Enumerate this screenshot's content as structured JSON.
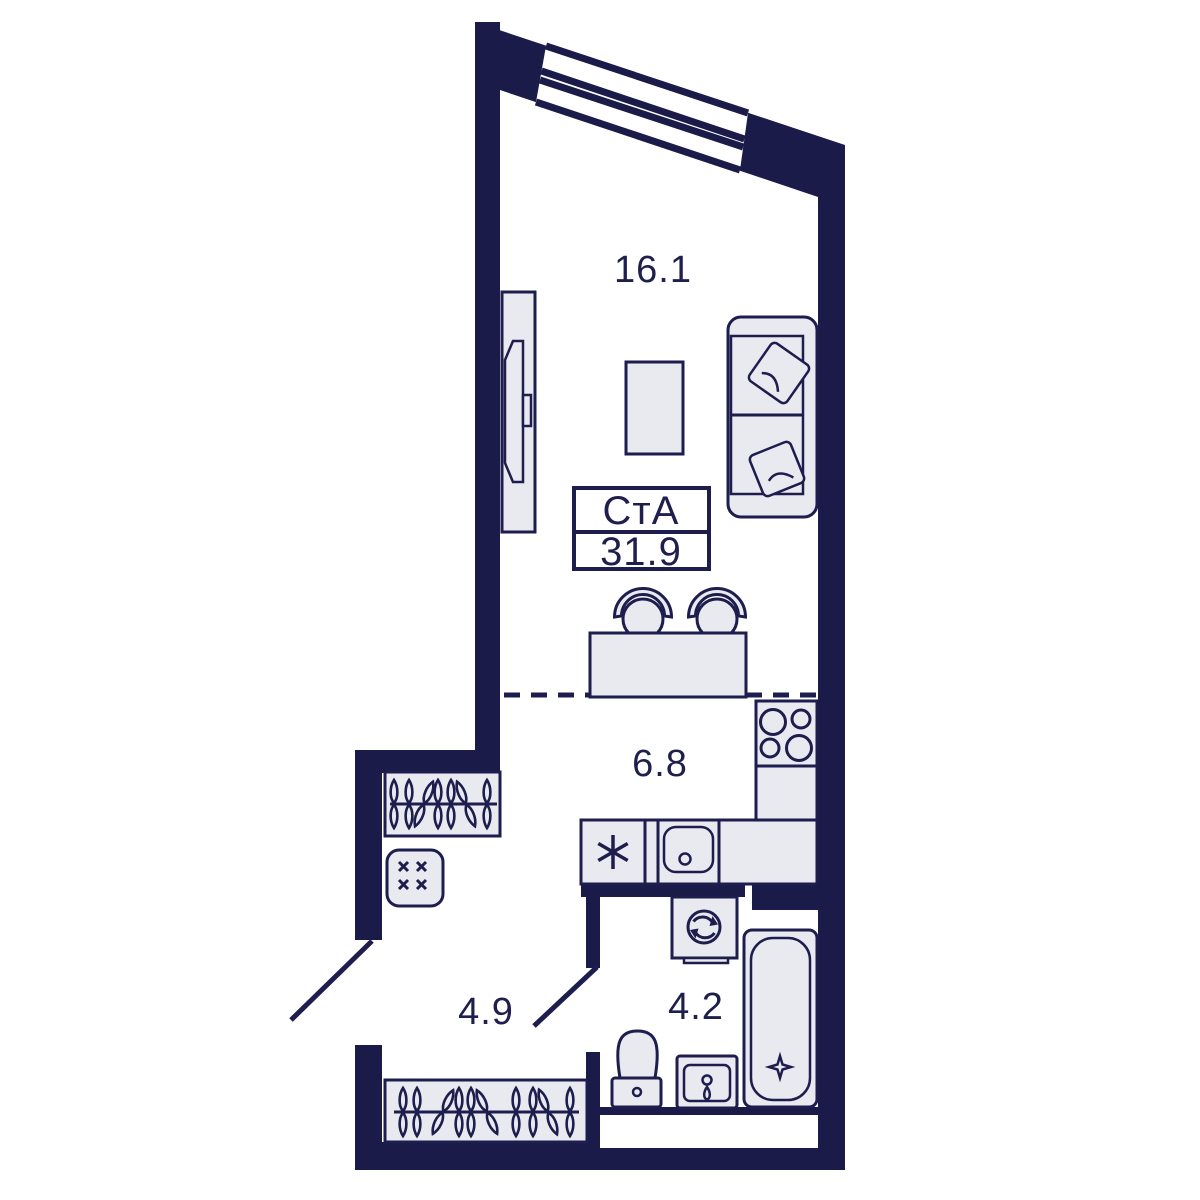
{
  "unit": {
    "type_label": "СтА",
    "total_area": "31.9"
  },
  "rooms": {
    "living": {
      "name": "living-room",
      "area": "16.1"
    },
    "kitchen": {
      "name": "kitchen",
      "area": "6.8"
    },
    "hallway": {
      "name": "hallway",
      "area": "4.9"
    },
    "bathroom": {
      "name": "bathroom",
      "area": "4.2"
    }
  },
  "fixtures": [
    "window",
    "sofa",
    "pillows",
    "tv",
    "tv-console",
    "coffee-table",
    "bar-table",
    "bar-stools",
    "stove",
    "kitchen-counter",
    "fridge",
    "kitchen-sink",
    "washing-machine",
    "bathtub",
    "toilet",
    "washbasin",
    "coat-rack-hangers",
    "wardrobe-hangers",
    "shoe-bench",
    "door-swings"
  ],
  "colors": {
    "wall": "#1b1b4a",
    "line": "#1d1d4e",
    "fixture_fill": "#e9e9f0",
    "text": "#1f1f4e",
    "background": "#ffffff"
  }
}
